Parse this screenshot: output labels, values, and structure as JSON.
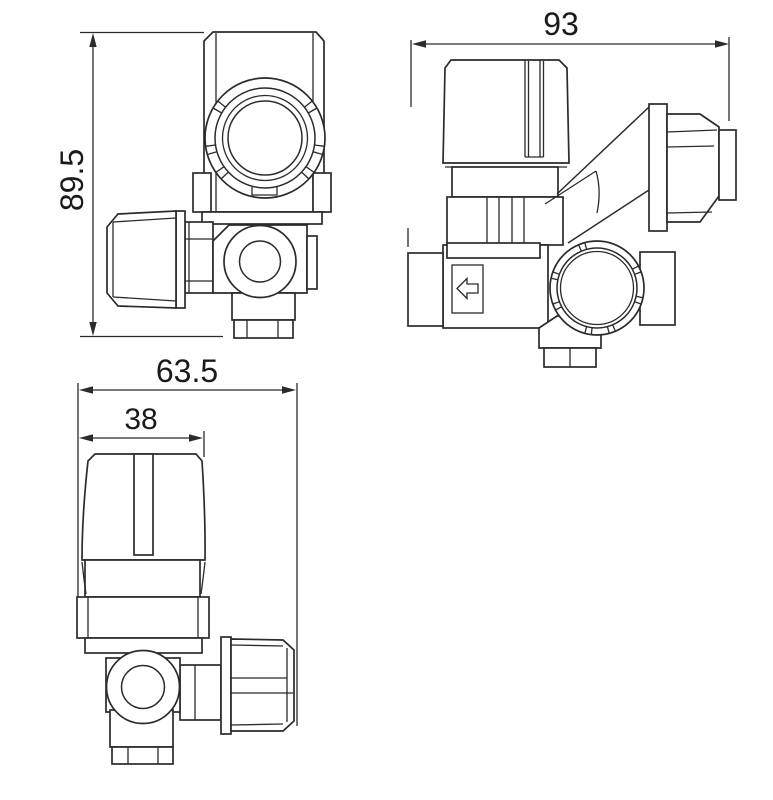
{
  "colors": {
    "background": "#ffffff",
    "line": "#2b2b2b",
    "text": "#1a1a1a"
  },
  "dimensions": {
    "front_height": "89.5",
    "side_width": "93",
    "top_overall_width": "63.5",
    "top_knob_width": "38"
  },
  "symbols": {
    "flow_direction_arrow": "left-arrow-in-box"
  }
}
